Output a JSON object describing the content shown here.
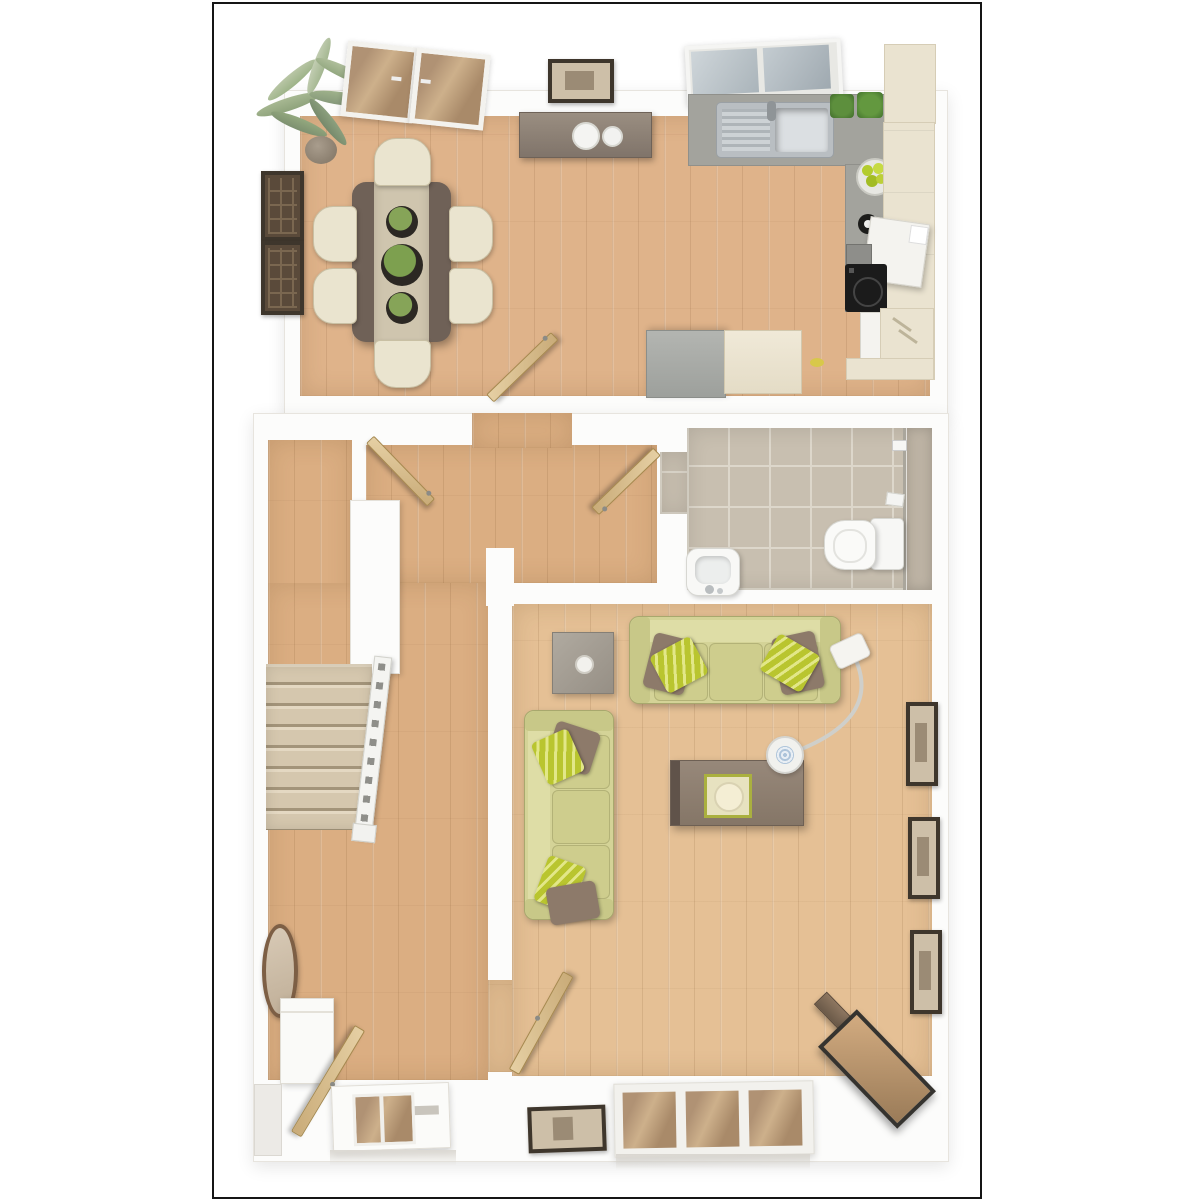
{
  "image_type": "3d-floor-plan-render",
  "floor_name": "ground-floor",
  "palette": {
    "frame_black": "#151515",
    "wall_white": "#fcfcfb",
    "floor_wood": "#dfb38a",
    "floor_wood_hall": "#dbae82",
    "floor_wood_light": "#e5c095",
    "floor_tile": "#c8bfb0",
    "counter_gray": "#a3a39d",
    "cabinet_cream": "#eae3d0",
    "table_dark": "#6f6157",
    "runner_beige": "#cfc5ae",
    "chair_cream": "#eae4cf",
    "sofa_olive": "#d4d397",
    "cushion_green": "#b9c52f",
    "pillow_brown": "#8d7a6a",
    "door_tan": "#d8bf93",
    "stair_carpet": "#d8cab2",
    "frame_dark": "#3e362c",
    "apple_green": "#b3cc2e",
    "glass_blue": "#b7c1c7",
    "glass_tan": "#c7a179",
    "tv_wood": "#6b5a49"
  },
  "rooms": [
    {
      "name": "kitchen-dining",
      "furniture": [
        "palm-plant",
        "wall-art-panels",
        "french-doors",
        "wall-picture",
        "kitchen-window",
        "sideboard-with-plates",
        "dining-table",
        "table-runner",
        "three-centerpiece-planters",
        "six-dining-chairs",
        "sink-with-drainer",
        "l-shaped-gray-counter",
        "herb-pots",
        "fruit-bowl",
        "kettle",
        "white-appliance",
        "induction-hob",
        "oven-front",
        "dishwasher",
        "cream-wall-cabinets",
        "peninsula-gray-unit",
        "peninsula-cream-unit",
        "open-door"
      ]
    },
    {
      "name": "hallway",
      "furniture": [
        "staircase",
        "stair-banister",
        "side-corridor",
        "open-door-left",
        "open-door-bathroom",
        "console-shelf",
        "oval-mirror",
        "front-door-glazed",
        "entrance-door-leaf",
        "porch-step"
      ]
    },
    {
      "name": "bathroom",
      "furniture": [
        "tiled-floor",
        "toilet-with-cistern",
        "wash-basin",
        "shower-glass-screen",
        "toilet-roll-holder",
        "shower-door-handle"
      ]
    },
    {
      "name": "living-room",
      "furniture": [
        "three-seat-sofa-top",
        "three-seat-sofa-left",
        "green-striped-cushions",
        "brown-pillows",
        "gray-side-table",
        "candle",
        "coffee-table-with-tray",
        "arc-floor-lamp",
        "three-wall-frames-right",
        "corner-tv-unit",
        "television",
        "bottom-window",
        "wall-picture-bottom",
        "open-door"
      ]
    }
  ],
  "counts": {
    "dining_chairs": 6,
    "sofas": 2,
    "wall_frames_living_right": 3,
    "stair_treads": 8,
    "centerpieces": 3,
    "sideboard_plates": 2,
    "herb_pots": 2
  }
}
